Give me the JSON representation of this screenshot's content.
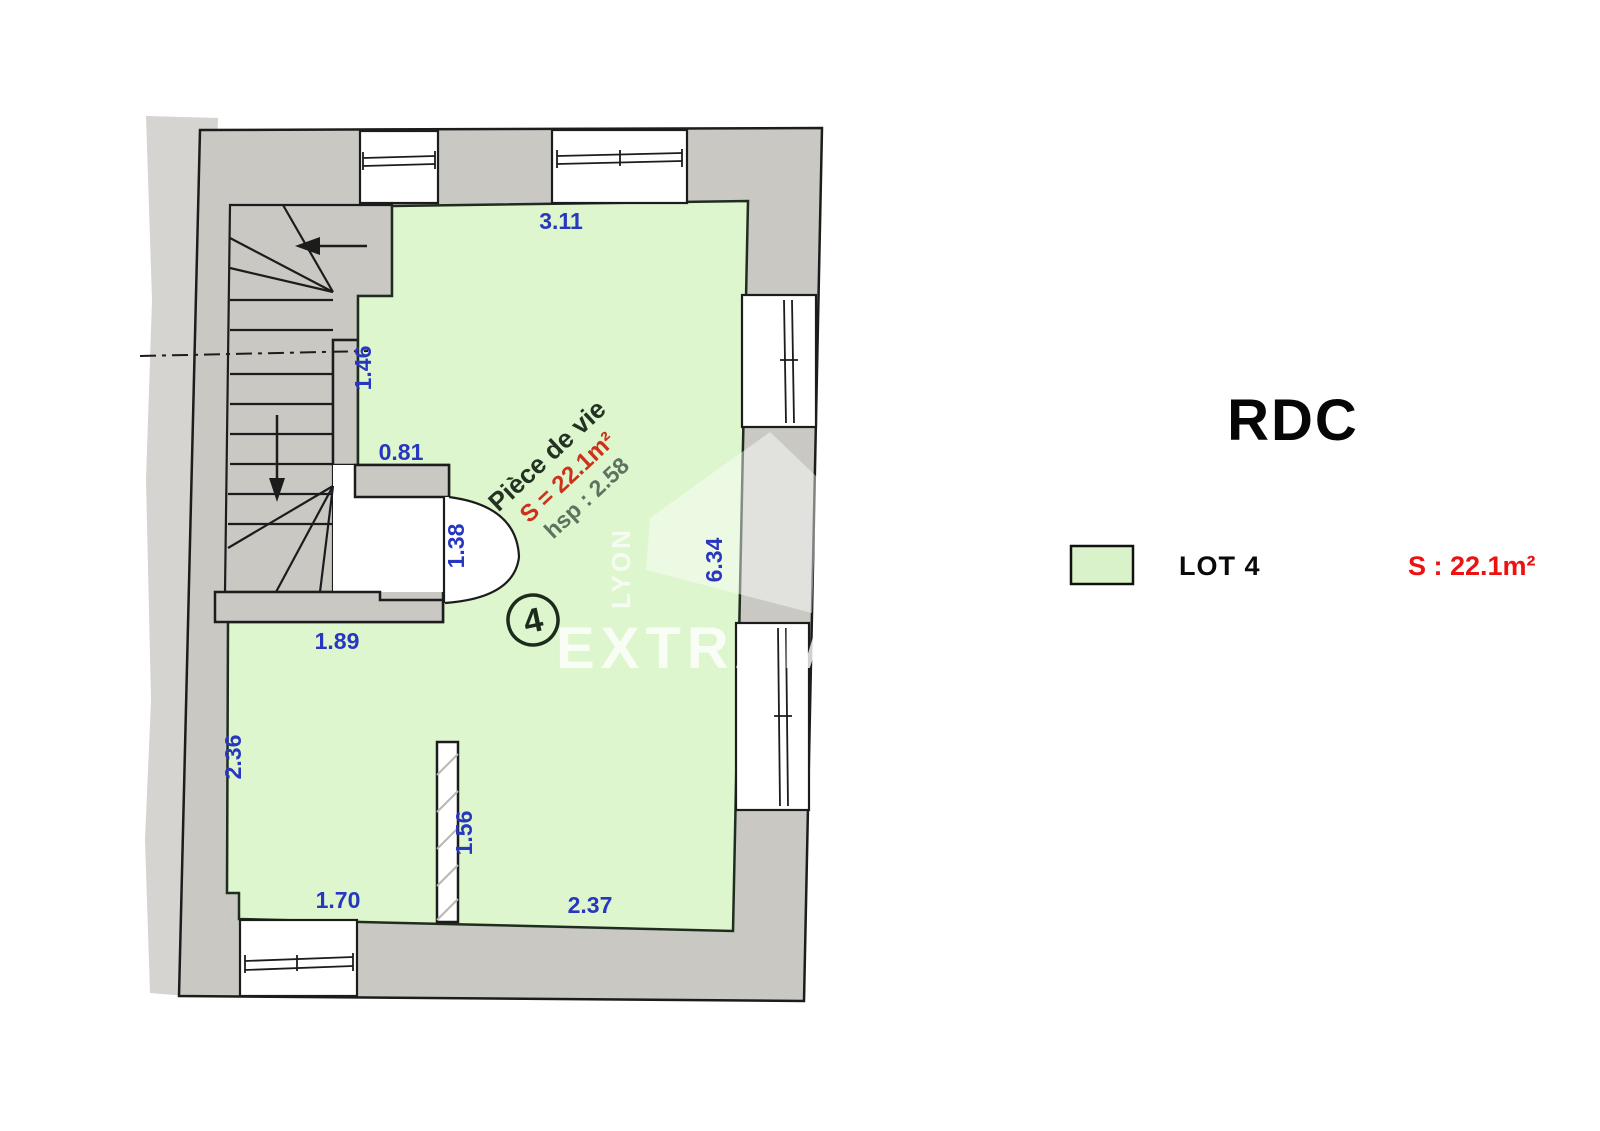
{
  "title": "RDC",
  "legend": {
    "lot_label": "LOT 4",
    "area_label": "S : 22.1m²",
    "swatch_color": "#d9f2c9"
  },
  "room": {
    "name": "Pièce de vie",
    "area": "S = 22.1m²",
    "ceiling_height": "hsp : 2.58",
    "lot_number": "4"
  },
  "dimensions": {
    "top_wall": "3.11",
    "left_upper_wall": "1.46",
    "stub_wall": "0.81",
    "door_opening": "1.38",
    "mid_wall": "1.89",
    "left_lower_wall": "2.36",
    "partition": "1.56",
    "bottom_left_wall": "1.70",
    "bottom_right_wall": "2.37",
    "right_wall": "6.34"
  },
  "watermark": {
    "brand": "EXTRAM",
    "city": "LYON"
  },
  "colors": {
    "lot_fill": "#ddf6cd",
    "wall_fill": "#c9c8c3",
    "outside_strip_fill": "#d5d4d0",
    "dim_text": "#2836c0",
    "room_area_text": "#cd311b",
    "legend_area_text": "#ee1111"
  }
}
